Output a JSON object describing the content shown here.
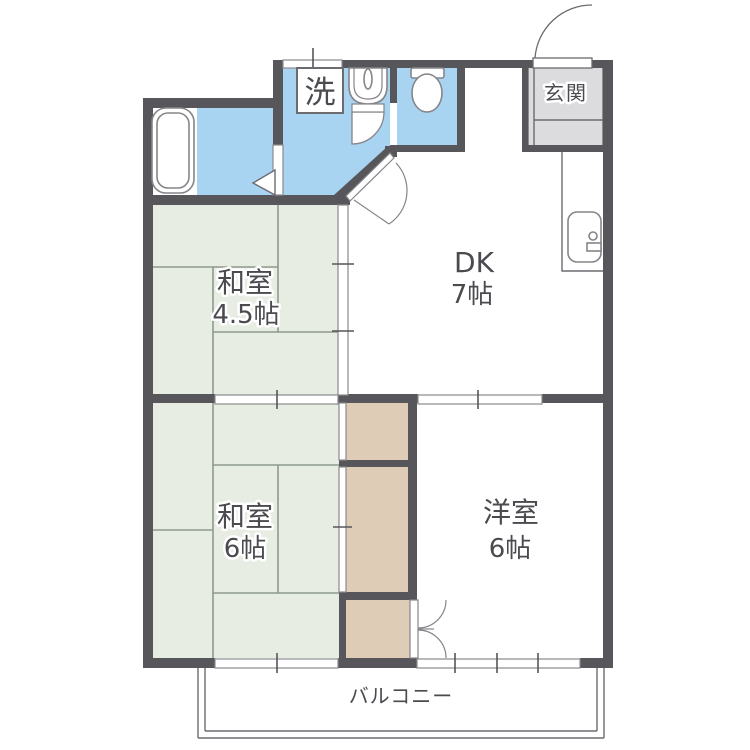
{
  "plan_title": "2DK apartment floor plan",
  "palette": {
    "wall": "#57575b",
    "water_area_fill": "#a8d4f2",
    "tatami_fill": "#e8ede4",
    "tatami_line": "#8d9a8c",
    "closet_fill": "#dfccb6",
    "genkan_fill": "#dcdcde",
    "outline_gray": "#6b6b70",
    "label_text": "#4a4a4f"
  },
  "rooms": {
    "washitsu_45": {
      "name": "和室",
      "size": "4.5帖"
    },
    "washitsu_6": {
      "name": "和室",
      "size": "6帖"
    },
    "dining_kitchen": {
      "name": "DK",
      "size": "7帖"
    },
    "youshitsu": {
      "name": "洋室",
      "size": "6帖"
    },
    "genkan": {
      "label": "玄関"
    },
    "balcony": {
      "label": "バルコニー"
    },
    "laundry": {
      "label": "洗"
    }
  },
  "fixtures": [
    "bathtub-icon",
    "bath-folding-door-icon",
    "washing-machine-box",
    "washbasin-icon",
    "toilet-icon",
    "kitchen-sink-icon",
    "entry-door-arc",
    "toilet-door-arc",
    "dk-door-arc",
    "closet-double-door-arc"
  ]
}
